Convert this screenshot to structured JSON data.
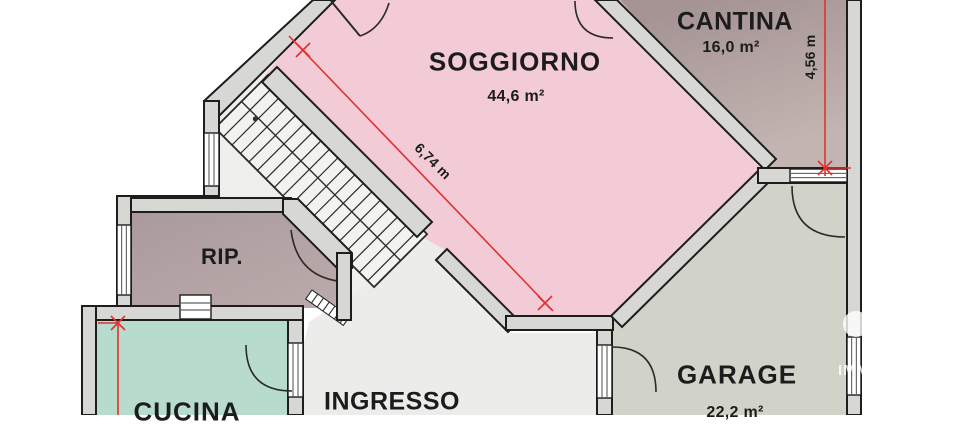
{
  "rooms": {
    "soggiorno": {
      "label": "SOGGIORNO",
      "area": "44,6 m²"
    },
    "cantina": {
      "label": "CANTINA",
      "area": "16,0 m²"
    },
    "rip": {
      "label": "RIP."
    },
    "cucina": {
      "label": "CUCINA"
    },
    "ingresso": {
      "label": "INGRESSO"
    },
    "garage": {
      "label": "GARAGE",
      "area": "22,2 m²"
    }
  },
  "dimensions": {
    "soggiorno_diagonal": "6,74 m",
    "cantina_side": "4,56 m"
  },
  "colors": {
    "soggiorno": "#f3cbd7",
    "cantina_top": "#a69495",
    "cantina_bottom": "#c3b5b1",
    "rip": "#b1a1a3",
    "cucina": "#b7dcce",
    "garage": "#d1d3c9",
    "ingresso": "#ecedeb",
    "stair_hall": "#efefed",
    "wall": "#d7d8d4",
    "outline": "#1d1d1d",
    "dimension_red": "#e0322d"
  },
  "watermark": "IMM"
}
